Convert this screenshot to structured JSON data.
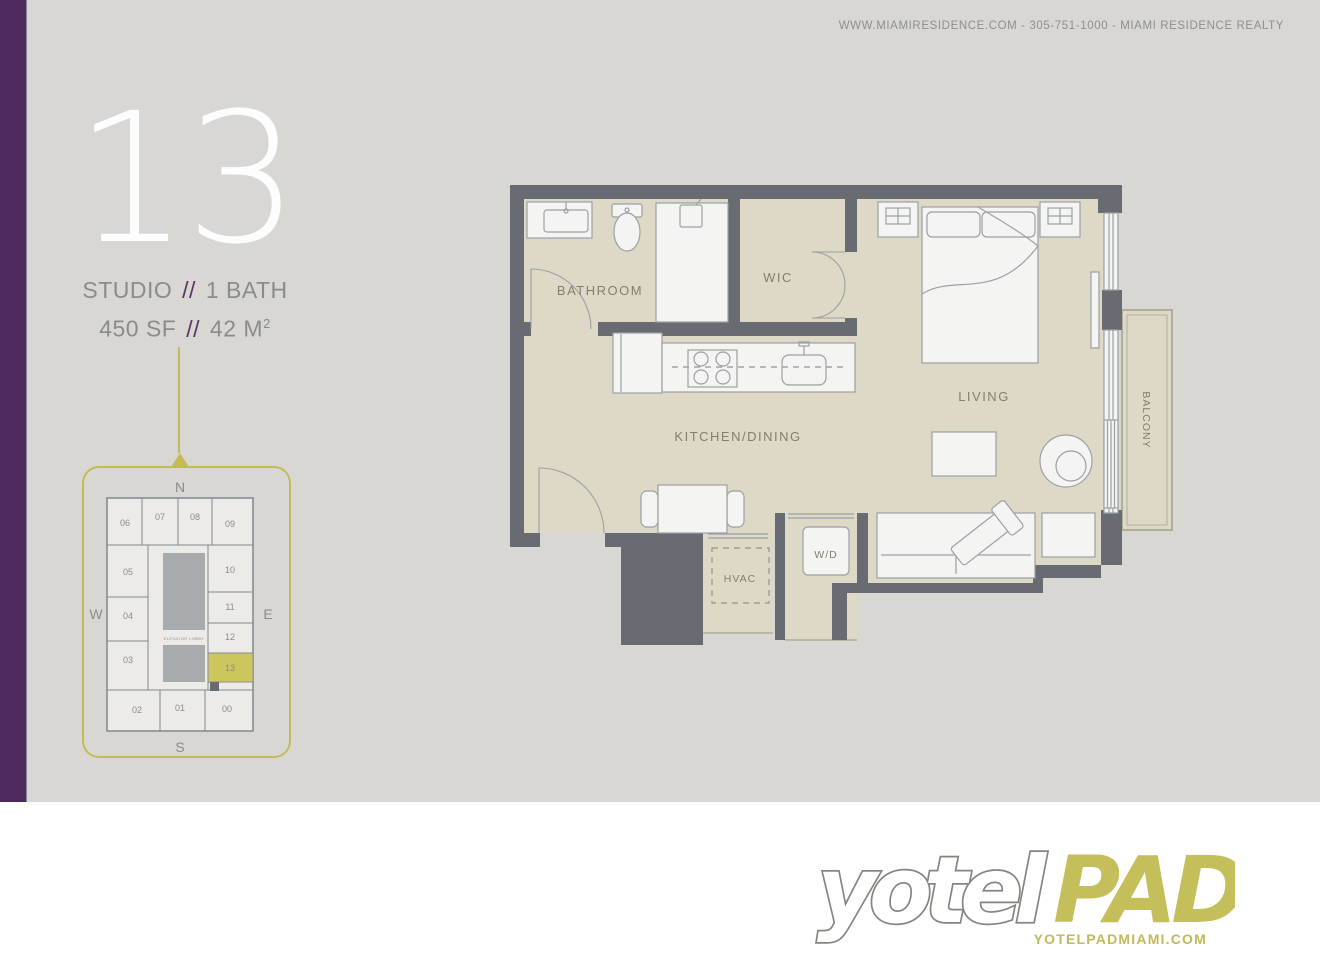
{
  "header": {
    "contact": "WWW.MIAMIRESIDENCE.COM  -  305-751-1000  -  MIAMI RESIDENCE REALTY"
  },
  "unit": {
    "number": "13",
    "type": "STUDIO",
    "separator": "//",
    "baths": "1 BATH",
    "area_imperial": "450 SF",
    "area_metric": "42 M",
    "area_metric_exponent": "2"
  },
  "keyplan": {
    "compass": {
      "north": "N",
      "south": "S",
      "east": "E",
      "west": "W"
    },
    "elevator_label": "ELEVATOR LOBBY",
    "highlighted_unit": "13",
    "units": [
      {
        "label": "06",
        "x": 45,
        "y": 76
      },
      {
        "label": "07",
        "x": 80,
        "y": 70
      },
      {
        "label": "08",
        "x": 115,
        "y": 70
      },
      {
        "label": "09",
        "x": 150,
        "y": 77
      },
      {
        "label": "05",
        "x": 48,
        "y": 125
      },
      {
        "label": "04",
        "x": 48,
        "y": 169
      },
      {
        "label": "03",
        "x": 48,
        "y": 213
      },
      {
        "label": "10",
        "x": 150,
        "y": 123
      },
      {
        "label": "11",
        "x": 150,
        "y": 160
      },
      {
        "label": "12",
        "x": 150,
        "y": 190
      },
      {
        "label": "13",
        "x": 150,
        "y": 221,
        "highlight": true
      },
      {
        "label": "02",
        "x": 57,
        "y": 263
      },
      {
        "label": "01",
        "x": 100,
        "y": 261
      },
      {
        "label": "00",
        "x": 147,
        "y": 262
      }
    ]
  },
  "floorplan": {
    "labels": {
      "bathroom": "BATHROOM",
      "wic": "WIC",
      "kitchen_dining": "KITCHEN/DINING",
      "living": "LIVING",
      "balcony": "BALCONY",
      "hvac": "HVAC",
      "washer_dryer": "W/D"
    }
  },
  "footer": {
    "logo_text_1": "yotel",
    "logo_text_2": "PAD",
    "website": "YOTELPADMIAMI.COM"
  },
  "colors": {
    "accent_purple": "#4e2a5e",
    "accent_olive": "#c2bc57",
    "highlight_unit": "#cdc65e",
    "wall": "#686c72",
    "floor": "#ded9c7",
    "background_gray": "#d8d7d3"
  }
}
